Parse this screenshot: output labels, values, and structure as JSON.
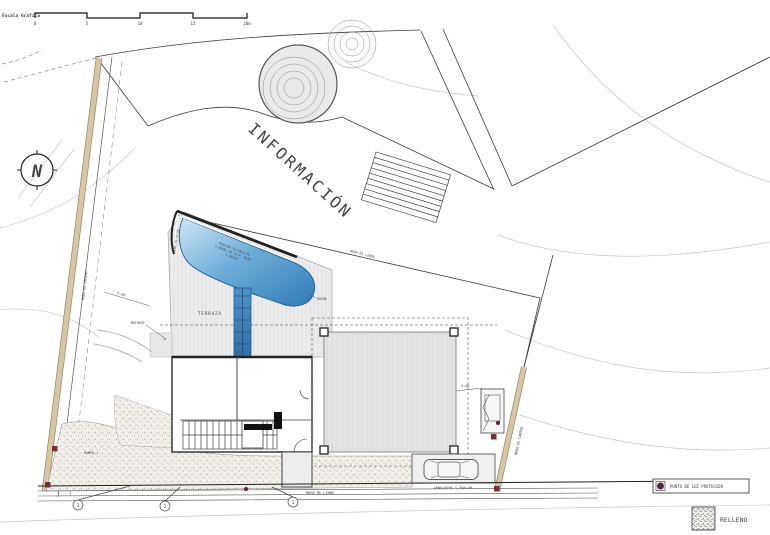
{
  "drawing": {
    "scale_bar": {
      "label": "Escala Gráfica",
      "t0": "0",
      "t1": "5",
      "t2": "10",
      "t3": "15",
      "t4": "20m"
    },
    "compass": {
      "n": "N"
    },
    "labels": {
      "informacion": "INFORMACIÓN",
      "terraza": "TERRAZA",
      "motores": "MOTORES",
      "ducha": "DUCHA",
      "rampa": "RAMPA 1",
      "aparcadero": "APARCADERO 5.35x6.00",
      "muro_linde_bottom": "MURO DE LINDE",
      "muro_linde_diagonal": "MURO DE LINDE",
      "muro_camino_left": "MURO DE CAMINO",
      "muro_camino_right": "MURO DE CAMINO",
      "muro_piedra": "MURO DE PIEDRA",
      "pool_line1": "PISCINA 11.50x4.50",
      "pool_line2": "A NIVEL DE LA P. BAJA",
      "pool_line3": "2 FOCOS",
      "pool_edge_level": "NIVEL EL 51.50",
      "dim_left": "5.00",
      "dim_right": "5.00"
    },
    "markers": {
      "m1": "1",
      "m2": "2",
      "m3": "3"
    },
    "legend": {
      "light": "PUNTO DE LUZ PROTEGIDO",
      "fill": "RELLENO"
    }
  },
  "colors": {
    "pool_light": "#c4e2f2",
    "pool_dark": "#2e7cb8",
    "wall_tan": "#d6c6a4",
    "wall_edge": "#9a8a6a",
    "marker_maroon": "#7a3030",
    "legend_dot": "#1f3864",
    "legend_dot_ring": "#c00000"
  }
}
